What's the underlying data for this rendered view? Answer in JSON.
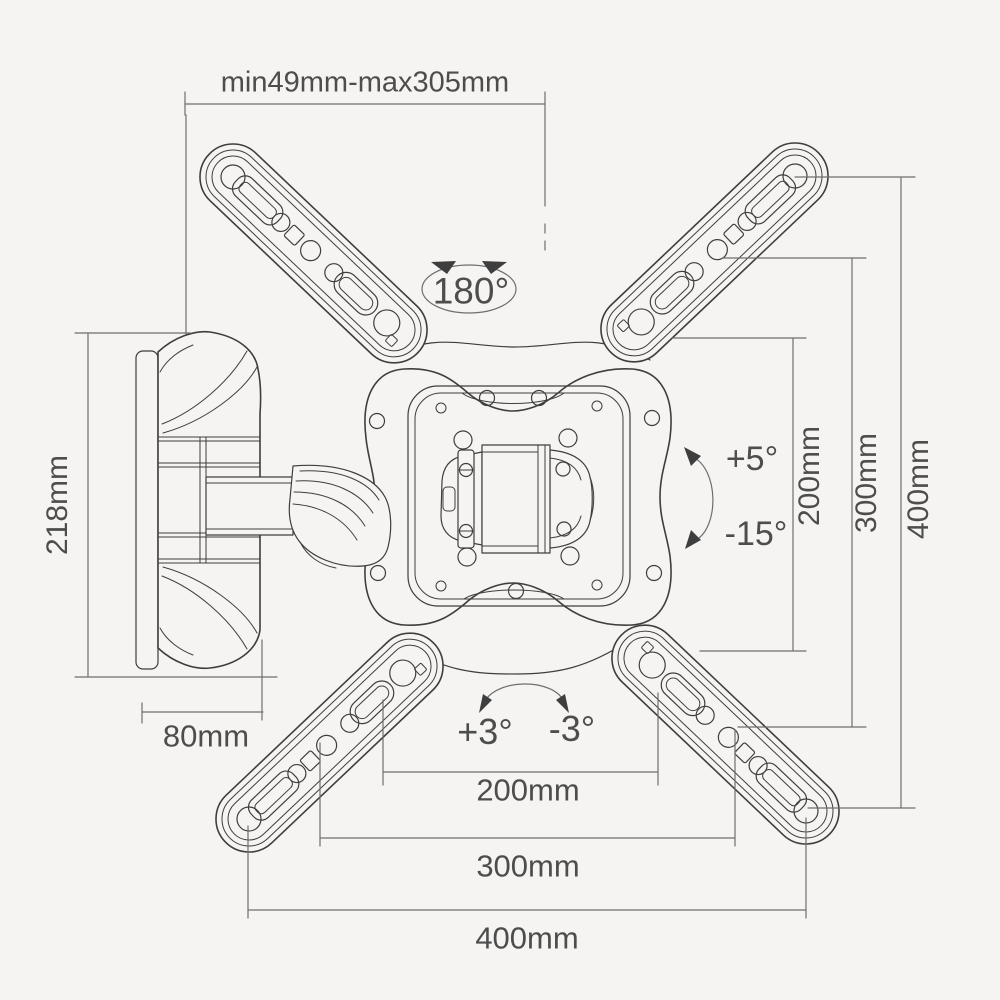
{
  "colors": {
    "paper": "#f5f4f2",
    "ink": "#3e3e3e",
    "dim": "#6e6e6e",
    "text": "#4d4d4d"
  },
  "labels": {
    "extension_range": "min49mm-max305mm",
    "swivel_range": "180°",
    "tilt_up": "+5°",
    "tilt_down": "-15°",
    "level_left": "+3°",
    "level_right": "-3°",
    "wall_plate_height": "218mm",
    "arm_depth": "80mm",
    "vesa_vertical": {
      "v200": "200mm",
      "v300": "300mm",
      "v400": "400mm"
    },
    "vesa_horizontal": {
      "h200": "200mm",
      "h300": "300mm",
      "h400": "400mm"
    }
  }
}
